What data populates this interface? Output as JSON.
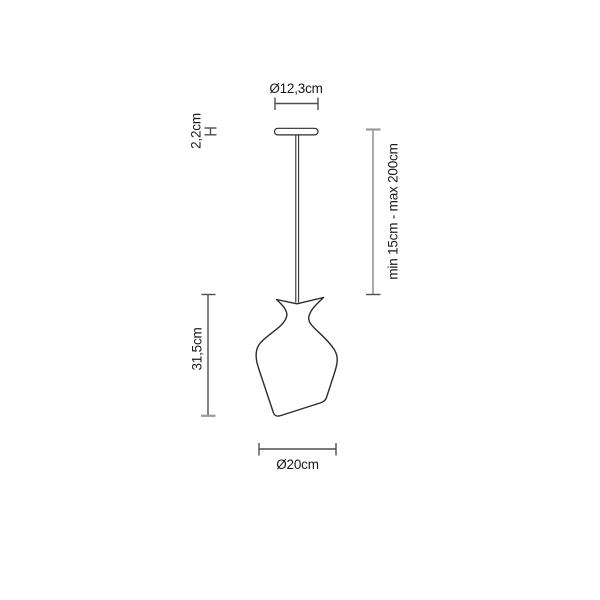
{
  "drawing": {
    "title": "pendant-lamp-dimension-drawing",
    "colors": {
      "background": "#ffffff",
      "outline": "#2b2b2b",
      "dimension_line": "#4f4f4f",
      "dimension_line_light": "#9a9a9a",
      "text": "#1a1a1a"
    },
    "dimensions": {
      "canopy_diameter": {
        "label": "Ø12,3cm"
      },
      "canopy_thickness": {
        "label": "2,2cm"
      },
      "suspension_length": {
        "label": "min 15cm - max 200cm"
      },
      "shade_height": {
        "label": "31,5cm"
      },
      "shade_diameter": {
        "label": "Ø20cm"
      }
    }
  }
}
